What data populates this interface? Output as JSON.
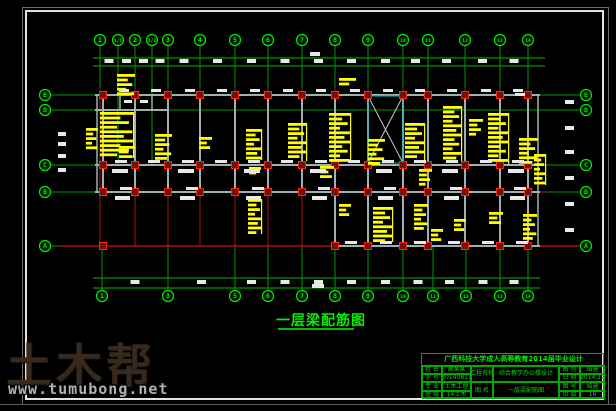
{
  "drawing_title": {
    "text": "一层梁配筋图"
  },
  "watermark": {
    "logo": "土木帮",
    "url": "www.tumubong.net"
  },
  "title_block": {
    "header": "广西科技大学成人高等教育2014届毕业设计",
    "left_rows": [
      {
        "label": "姓 名",
        "value": "黄某某"
      },
      {
        "label": "学 号",
        "value": "20140811"
      },
      {
        "label": "专 业",
        "value": "土木工程"
      },
      {
        "label": "班 级",
        "value": "14土木"
      }
    ],
    "mid_rows": [
      {
        "label": "工程名称",
        "value": "综合教学办公楼设计"
      },
      {
        "label": "图 名",
        "value": "一层梁配筋图"
      }
    ],
    "right_rows": [
      {
        "label": "图 别",
        "value": "结施"
      },
      {
        "label": "日 期",
        "value": "2014.11"
      },
      {
        "label": "图 号",
        "value": "结施"
      },
      {
        "label": "页 数",
        "value": "16"
      }
    ]
  },
  "colors": {
    "green_bright": "#00ee00",
    "green": "#00bb00",
    "green_dim": "#009900",
    "red": "#cc1010",
    "dark_red": "#8b1a1a",
    "column_fill": "#6e1111",
    "column_stroke": "#ff2600",
    "beam": "#9fb0b0",
    "cyan": "#00b0b0",
    "yellow": "#ffff00",
    "white": "#e8e8e8"
  },
  "drawing": {
    "top_axes": [
      {
        "x": 100,
        "label": "1"
      },
      {
        "x": 118,
        "label": "1/1"
      },
      {
        "x": 135,
        "label": "2"
      },
      {
        "x": 152,
        "label": "1/2"
      },
      {
        "x": 168,
        "label": "3"
      },
      {
        "x": 200,
        "label": "4"
      },
      {
        "x": 235,
        "label": "5"
      },
      {
        "x": 268,
        "label": "6"
      },
      {
        "x": 302,
        "label": "7"
      },
      {
        "x": 335,
        "label": "8"
      },
      {
        "x": 368,
        "label": "9"
      },
      {
        "x": 403,
        "label": "10"
      },
      {
        "x": 428,
        "label": "11"
      },
      {
        "x": 465,
        "label": "12"
      },
      {
        "x": 500,
        "label": "13"
      },
      {
        "x": 528,
        "label": "14"
      }
    ],
    "bottom_axes": [
      {
        "x": 102,
        "label": "1"
      },
      {
        "x": 168,
        "label": "3"
      },
      {
        "x": 235,
        "label": "5"
      },
      {
        "x": 268,
        "label": "6"
      },
      {
        "x": 302,
        "label": "7"
      },
      {
        "x": 335,
        "label": "8"
      },
      {
        "x": 368,
        "label": "9"
      },
      {
        "x": 403,
        "label": "10"
      },
      {
        "x": 433,
        "label": "11"
      },
      {
        "x": 466,
        "label": "12"
      },
      {
        "x": 500,
        "label": "13"
      },
      {
        "x": 528,
        "label": "14"
      }
    ],
    "left_axes": [
      {
        "y": 95,
        "label": "E"
      },
      {
        "y": 110,
        "label": "D"
      },
      {
        "y": 165,
        "label": "C"
      },
      {
        "y": 192,
        "label": "B"
      },
      {
        "y": 246,
        "label": "A"
      }
    ],
    "right_axes": [
      {
        "y": 95,
        "label": "E"
      },
      {
        "y": 110,
        "label": "D"
      },
      {
        "y": 165,
        "label": "C"
      },
      {
        "y": 192,
        "label": "B"
      },
      {
        "y": 246,
        "label": "A"
      }
    ],
    "dim_lines": {
      "top_ys": [
        58,
        66
      ],
      "top_x": [
        93,
        545
      ],
      "bottom_ys": [
        278,
        288
      ],
      "bottom_x": [
        93,
        540
      ]
    },
    "beams_h": [
      [
        95,
        95,
        540
      ],
      [
        95,
        110,
        168
      ],
      [
        95,
        165,
        540
      ],
      [
        95,
        192,
        540
      ],
      [
        335,
        246,
        540
      ]
    ],
    "v_beam_xs_EB": [
      103,
      135,
      168,
      200,
      235,
      268,
      302,
      335,
      368,
      403,
      428,
      465,
      500,
      528
    ],
    "v_beam_xs_BA": [
      335,
      368,
      403,
      428,
      465,
      500,
      528
    ],
    "beams_v_extra": [
      [
        97,
        95,
        192
      ],
      [
        538,
        95,
        246
      ],
      [
        120,
        95,
        110
      ],
      [
        135,
        95,
        110
      ],
      [
        152,
        95,
        110
      ]
    ],
    "stair": {
      "x": 368,
      "y": 96,
      "w": 35,
      "h": 67
    },
    "red": {
      "vertical_span": [
        87,
        246
      ],
      "h_lines": [
        {
          "y": 246,
          "x1": 60,
          "x2": 584,
          "color": "#cc1010"
        },
        {
          "y": 165,
          "x1": 95,
          "x2": 545,
          "color": "#8b1a1a"
        },
        {
          "y": 192,
          "x1": 95,
          "x2": 545,
          "color": "#8b1a1a"
        }
      ]
    },
    "columns": {
      "size": 7,
      "rows": [
        {
          "y": 95,
          "xs": [
            103,
            135,
            168,
            200,
            235,
            268,
            302,
            335,
            368,
            403,
            428,
            465,
            500,
            528
          ]
        },
        {
          "y": 165,
          "xs": [
            103,
            135,
            168,
            200,
            235,
            268,
            302,
            335,
            368,
            403,
            428,
            465,
            500,
            528
          ]
        },
        {
          "y": 192,
          "xs": [
            103,
            135,
            168,
            200,
            235,
            268,
            302,
            335,
            368,
            403,
            428,
            465,
            500,
            528
          ]
        },
        {
          "y": 246,
          "xs": [
            103,
            335,
            368,
            403,
            428,
            465,
            500,
            528
          ]
        }
      ]
    },
    "yellow_blocks": [
      [
        86,
        128,
        12,
        24
      ],
      [
        100,
        112,
        34,
        46
      ],
      [
        117,
        74,
        18,
        24
      ],
      [
        119,
        146,
        16,
        16
      ],
      [
        155,
        134,
        17,
        26
      ],
      [
        199,
        137,
        13,
        16
      ],
      [
        246,
        129,
        16,
        31
      ],
      [
        288,
        123,
        19,
        38
      ],
      [
        329,
        113,
        22,
        49
      ],
      [
        339,
        78,
        17,
        11
      ],
      [
        368,
        139,
        17,
        26
      ],
      [
        405,
        123,
        20,
        38
      ],
      [
        443,
        106,
        19,
        55
      ],
      [
        469,
        119,
        14,
        20
      ],
      [
        488,
        113,
        21,
        51
      ],
      [
        519,
        138,
        19,
        27
      ],
      [
        534,
        154,
        12,
        31
      ],
      [
        248,
        199,
        14,
        35
      ],
      [
        320,
        166,
        14,
        12
      ],
      [
        419,
        169,
        13,
        18
      ],
      [
        339,
        204,
        12,
        15
      ],
      [
        373,
        207,
        20,
        35
      ],
      [
        414,
        204,
        14,
        29
      ],
      [
        454,
        219,
        12,
        13
      ],
      [
        489,
        212,
        14,
        14
      ],
      [
        523,
        214,
        14,
        29
      ],
      [
        431,
        229,
        12,
        12
      ],
      [
        249,
        167,
        12,
        10
      ]
    ],
    "white_marks": [
      [
        119,
        89,
        10,
        3
      ],
      [
        151,
        89,
        10,
        3
      ],
      [
        185,
        89,
        10,
        3
      ],
      [
        217,
        89,
        10,
        3
      ],
      [
        250,
        89,
        10,
        3
      ],
      [
        283,
        89,
        10,
        3
      ],
      [
        316,
        89,
        10,
        3
      ],
      [
        350,
        89,
        10,
        3
      ],
      [
        383,
        89,
        10,
        3
      ],
      [
        415,
        89,
        10,
        3
      ],
      [
        447,
        89,
        10,
        3
      ],
      [
        481,
        89,
        10,
        3
      ],
      [
        513,
        89,
        10,
        3
      ],
      [
        115,
        160,
        12,
        3
      ],
      [
        148,
        160,
        12,
        3
      ],
      [
        182,
        160,
        12,
        3
      ],
      [
        215,
        160,
        12,
        3
      ],
      [
        248,
        160,
        12,
        3
      ],
      [
        281,
        160,
        12,
        3
      ],
      [
        315,
        160,
        12,
        3
      ],
      [
        348,
        160,
        12,
        3
      ],
      [
        382,
        160,
        12,
        3
      ],
      [
        414,
        160,
        12,
        3
      ],
      [
        446,
        160,
        12,
        3
      ],
      [
        480,
        160,
        12,
        3
      ],
      [
        512,
        160,
        12,
        3
      ],
      [
        112,
        169,
        16,
        4
      ],
      [
        178,
        169,
        16,
        4
      ],
      [
        244,
        169,
        16,
        4
      ],
      [
        310,
        169,
        16,
        4
      ],
      [
        376,
        169,
        16,
        4
      ],
      [
        442,
        169,
        16,
        4
      ],
      [
        508,
        169,
        16,
        4
      ],
      [
        120,
        187,
        12,
        3
      ],
      [
        186,
        187,
        12,
        3
      ],
      [
        252,
        187,
        12,
        3
      ],
      [
        318,
        187,
        12,
        3
      ],
      [
        384,
        187,
        12,
        3
      ],
      [
        450,
        187,
        12,
        3
      ],
      [
        514,
        187,
        12,
        3
      ],
      [
        115,
        196,
        15,
        4
      ],
      [
        180,
        196,
        15,
        4
      ],
      [
        246,
        196,
        15,
        4
      ],
      [
        312,
        196,
        15,
        4
      ],
      [
        378,
        196,
        15,
        4
      ],
      [
        444,
        196,
        15,
        4
      ],
      [
        510,
        196,
        15,
        4
      ],
      [
        345,
        241,
        12,
        3
      ],
      [
        380,
        241,
        12,
        3
      ],
      [
        414,
        241,
        12,
        3
      ],
      [
        448,
        241,
        12,
        3
      ],
      [
        482,
        241,
        12,
        3
      ],
      [
        516,
        241,
        12,
        3
      ],
      [
        565,
        100,
        9,
        4
      ],
      [
        565,
        126,
        9,
        4
      ],
      [
        565,
        150,
        9,
        4
      ],
      [
        565,
        176,
        9,
        4
      ],
      [
        565,
        202,
        9,
        4
      ],
      [
        565,
        228,
        9,
        4
      ],
      [
        58,
        132,
        8,
        4
      ],
      [
        58,
        142,
        8,
        4
      ],
      [
        58,
        154,
        8,
        4
      ],
      [
        58,
        168,
        8,
        4
      ],
      [
        124,
        100,
        8,
        3
      ],
      [
        140,
        100,
        8,
        3
      ],
      [
        515,
        93,
        10,
        3
      ],
      [
        310,
        52,
        10,
        4
      ],
      [
        312,
        284,
        12,
        4
      ]
    ]
  }
}
